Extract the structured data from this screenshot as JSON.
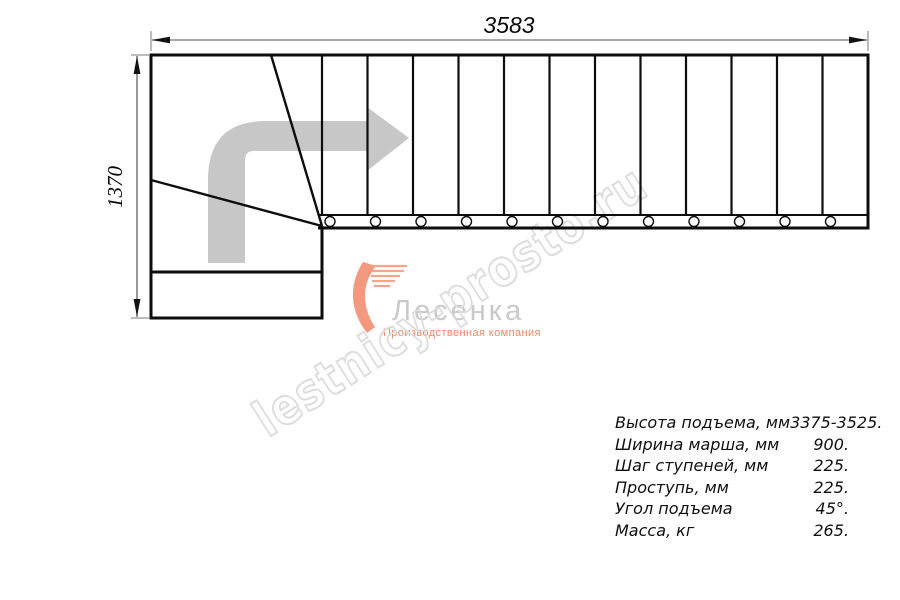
{
  "dimensions": {
    "width_mm": "3583",
    "height_mm": "1370"
  },
  "specs": {
    "rows": [
      {
        "label": "Высота подъема, мм",
        "value": "3375-3525."
      },
      {
        "label": "Ширина марша, мм",
        "value": "900."
      },
      {
        "label": "Шаг ступеней, мм",
        "value": "225."
      },
      {
        "label": "Проступь, мм",
        "value": "225."
      },
      {
        "label": "Угол подъема",
        "value": "45°."
      },
      {
        "label": "Масса, кг",
        "value": "265."
      }
    ]
  },
  "watermark": {
    "text": "lestnicy-prosto.ru"
  },
  "logo": {
    "name": "Лесенка",
    "tagline": "Производственная компания"
  },
  "colors": {
    "line": "#0d0d0d",
    "dim": "#7a7a7a",
    "arrow": "#c7c7c7",
    "watermark": "#dcdcdc",
    "logo_text": "#c9c9c9",
    "logo_accent": "#f0876a"
  }
}
